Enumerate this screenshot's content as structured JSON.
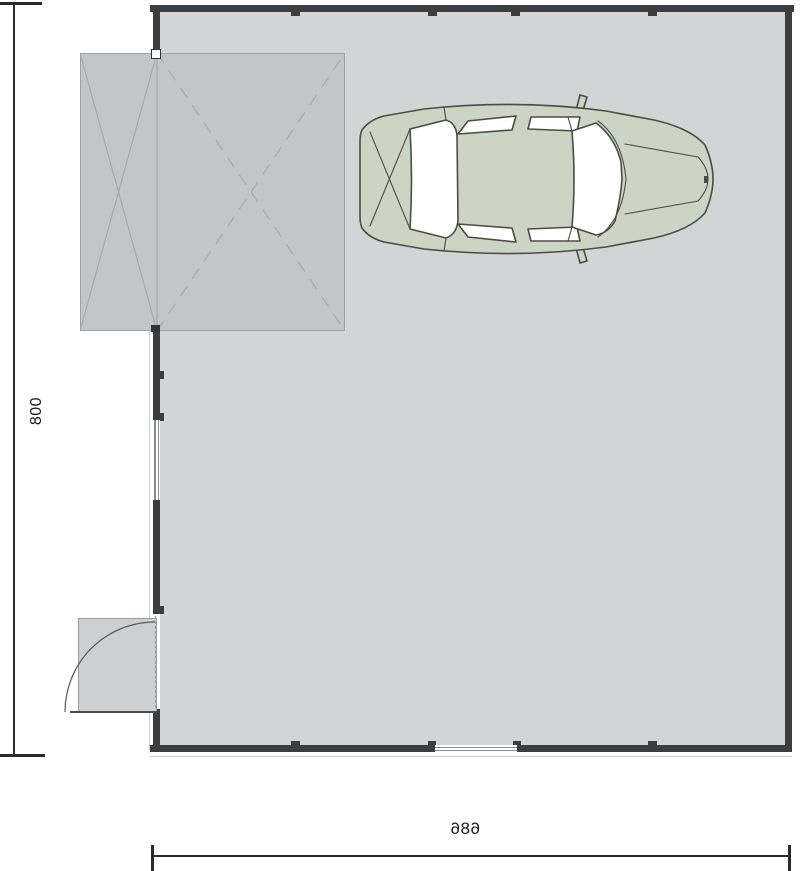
{
  "plan": {
    "kind_label": "garage floor plan",
    "elements": [
      "garage-door-panel",
      "car-top-view",
      "entry-door",
      "window-left",
      "window-bottom"
    ]
  },
  "dimensions": {
    "left": {
      "value": "800"
    },
    "bottom": {
      "value": "686"
    }
  },
  "colors": {
    "wall": "#3a3e40",
    "floor": "#d3d4d6",
    "door_panel": "#c4c5c7",
    "panel_line": "#a8a9ab",
    "car_body": "#ccd4c3",
    "car_outline": "#4c4c46",
    "swing_area": "#cdcfd1",
    "dimension_line": "#2b2b2b",
    "glazing": "#8a8b8d"
  }
}
